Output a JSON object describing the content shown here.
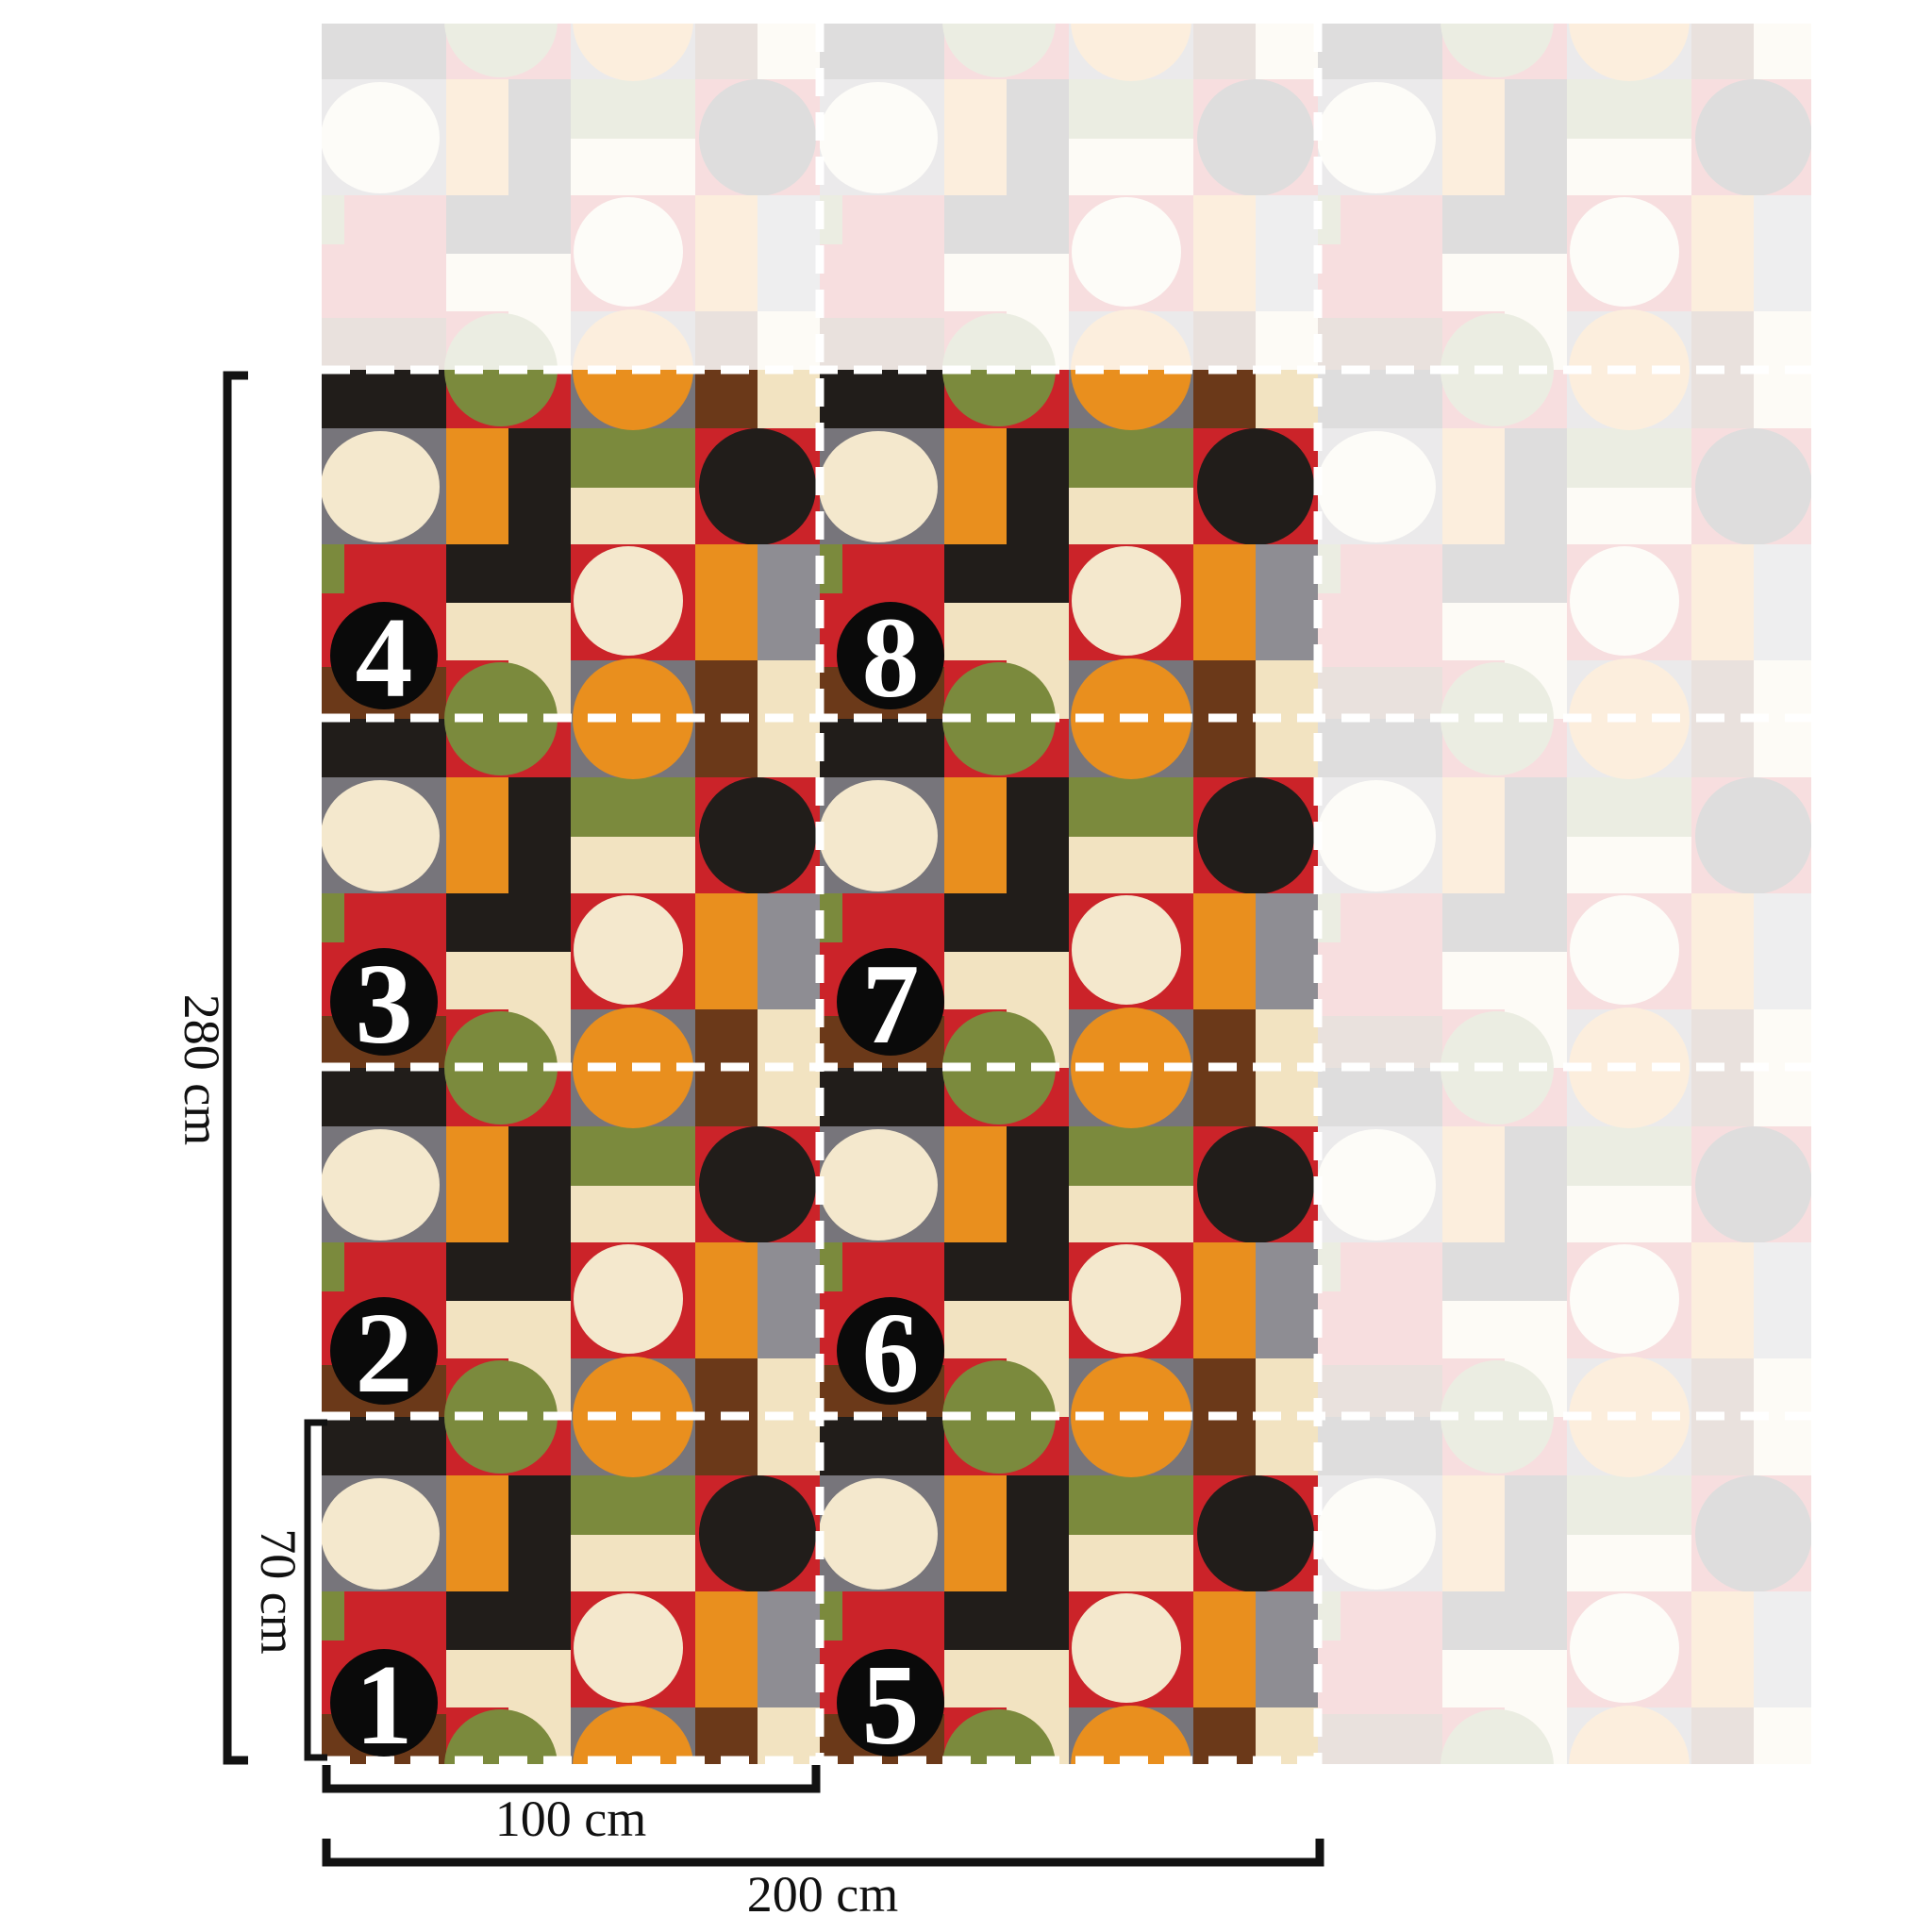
{
  "diagram": {
    "type": "wallpaper-panel-layout",
    "pattern_style": "bauhaus-geometric",
    "panels_total": 8,
    "columns_shown_vivid": 2,
    "rows_per_column": 4
  },
  "panel_badges": {
    "items": [
      {
        "label": "1"
      },
      {
        "label": "2"
      },
      {
        "label": "3"
      },
      {
        "label": "4"
      },
      {
        "label": "5"
      },
      {
        "label": "6"
      },
      {
        "label": "7"
      },
      {
        "label": "8"
      }
    ]
  },
  "dimensions": {
    "total_height": {
      "label": "280 cm"
    },
    "panel_height": {
      "label": "70 cm"
    },
    "panel_width": {
      "label": "100 cm"
    },
    "total_width": {
      "label": "200 cm"
    }
  },
  "colors": {
    "pattern_black": "#211d1a",
    "pattern_cream": "#f2e3c1",
    "pattern_cream_light": "#f4e8cd",
    "pattern_red": "#cb2329",
    "pattern_orange": "#e98f1e",
    "pattern_olive": "#7b8a3d",
    "pattern_gray": "#77757b",
    "pattern_gray_light": "#8e8d93",
    "pattern_brown": "#6b3919",
    "cut_line": "#ffffff",
    "badge_fill": "#0a0a0a",
    "badge_text": "#ffffff",
    "dimension_ink": "#111111",
    "background": "#ffffff"
  }
}
